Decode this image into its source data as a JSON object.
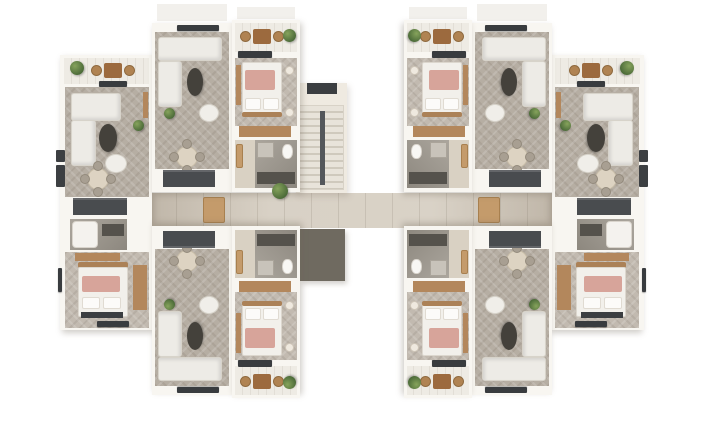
{
  "image": {
    "kind": "3d-architectural-floor-plan-render",
    "description": "Top-down photorealistic floor plan of a residential building storey; two mirrored wings of furnished apartments joined by a central corridor and staircase; no visible text labels",
    "width_px": 727,
    "height_px": 439,
    "background": "#ffffff"
  },
  "building": {
    "center_elements": {
      "corridor": "horizontal shared hallway with plank flooring",
      "staircase": "central stair flight with treads and handrail",
      "service_room": "dark-floored utility/stair shaft below corridor",
      "void": "white elevator / light well"
    },
    "unit_types": [
      {
        "name": "outer-corner-apartment",
        "rooms": [
          "balcony",
          "living-dining-room",
          "kitchen",
          "bathroom",
          "bedroom"
        ]
      },
      {
        "name": "inner-living-unit",
        "rooms": [
          "living-room",
          "dining-area",
          "kitchen"
        ]
      },
      {
        "name": "middle-bedroom-unit",
        "rooms": [
          "balcony",
          "bedroom",
          "entry-hall",
          "bathroom"
        ]
      }
    ],
    "furniture_seen": [
      "l-shaped-sofa",
      "armchair",
      "oval-coffee-table",
      "round-dining-table-4-chairs",
      "double-bed",
      "pillows",
      "pink-throw-blanket",
      "wardrobe",
      "kitchen-counter",
      "bathtub",
      "toilet",
      "washer",
      "balcony-table-2-chairs",
      "potted-plants",
      "ac-units",
      "window-bars"
    ]
  },
  "palette": {
    "wall": "#f8f6f1",
    "floor_living_herringbone": "#b6aea3",
    "floor_bedroom": "#c2bab0",
    "floor_corridor_plank": "#d4ccbf",
    "floor_balcony": "#eeebe4",
    "floor_bathroom": "#9d978d",
    "dark_fixture": "#3b3e41",
    "kitchen_counter": "#494c4f",
    "wood": "#b3875c",
    "wood_dark": "#9c6a3e",
    "sofa": "#edebe6",
    "bed_linen": "#f2f0eb",
    "throw_pink": "#d7a49a",
    "plant_green": "#5d7d44",
    "stair_tread": "#e0dacf",
    "service_room_floor": "#6f6a60"
  }
}
